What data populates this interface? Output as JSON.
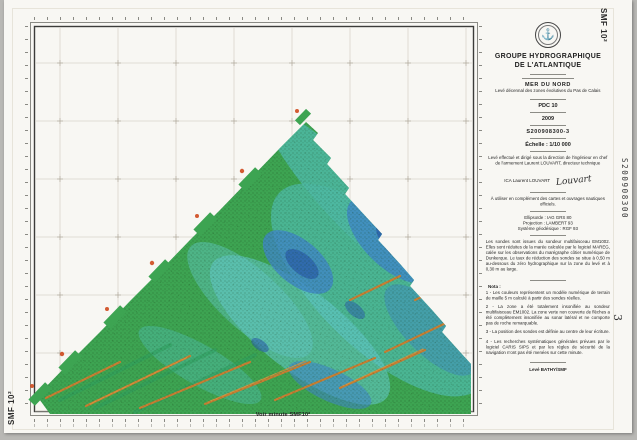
{
  "sheet": {
    "corner_label_top_right": "SMF 10²",
    "corner_label_bottom_left": "SMF 10²",
    "handwritten_registration": "S200908300",
    "handwritten_sheet_number": "3",
    "map_caption": "Voir minute SMF10²"
  },
  "title_block": {
    "logo_icon": "anchor-emblem",
    "organization_line1": "GROUPE HYDROGRAPHIQUE",
    "organization_line2": "DE L'ATLANTIQUE",
    "sea_area": "MER DU NORD",
    "survey_title": "Levé décennal des zones évolutives du Pas de Calais",
    "sheet_code": "PDC 10",
    "year": "2009",
    "registration_number": "S200908300-3",
    "scale_label": "Échelle : 1/10 000",
    "direction_note": "Levé effectué et dirigé sous la direction de l'ingénieur en chef de l'armement Laurent LOUVART, directeur technique",
    "signatory_title": "ICA Laurent LOUVART",
    "signature_script": "Louvart",
    "usage_note": "À utiliser en complément des cartes et ouvrages nautiques officiels.",
    "geodesy_line1": "Ellipsoïde : IAG GRS 80",
    "geodesy_line2": "Projection : LAMBERT 93",
    "geodesy_line3": "Système géodésique : RGF 93",
    "sounding_note": "Les sondes sont issues du sondeur multifaisceau EM1002. Elles sont réduites de la marée calculée par le logiciel MAREG, calée sur les observations du marégraphe côtier numérique de Dunkerque. Le taux de réduction des sondes se situe à 0,50 m au-dessous du zéro hydrographique sur la zone du levé et à 0,30 m au large.",
    "nota_label": "Nota :",
    "nota_1": "1 -  Les couleurs représentent un modèle numérique de terrain de maille 5 m calculé à partir des sondes réelles.",
    "nota_2": "2 -  La zone a été totalement insonifiée au sondeur multifaisceau EM1002. La zone verte non couverte de flèches a été complètement insonifiée au sonar latéral et ne comporte pas de roche remarquable.",
    "nota_3": "3 -  La position des sondes est définie au centre de leur écriture.",
    "nota_4": "4 -  Les recherches systématiques générales prévues par le logiciel CARIS SIPS et par les règles de sécurité de la navigation n'ont pas été menées sur cette minute.",
    "survey_footer": "Levé BATHY/SMF"
  },
  "map": {
    "palette": {
      "frame-dark": "#3c3c3a",
      "grid-line": "#d9d4cb",
      "cross-mark": "#b3ab9f",
      "swath-green": "#3da452",
      "teal": "#4db9a4",
      "cyan": "#63c8c8",
      "blue": "#3f86c6",
      "deep-blue": "#2c61aa",
      "stripe-green": "#2f9e5f",
      "ridge-orange": "#c87f33",
      "ridge-bright": "#d9953f",
      "spot-red": "#cf4a1e",
      "sounding-dot": "#14350f"
    }
  }
}
